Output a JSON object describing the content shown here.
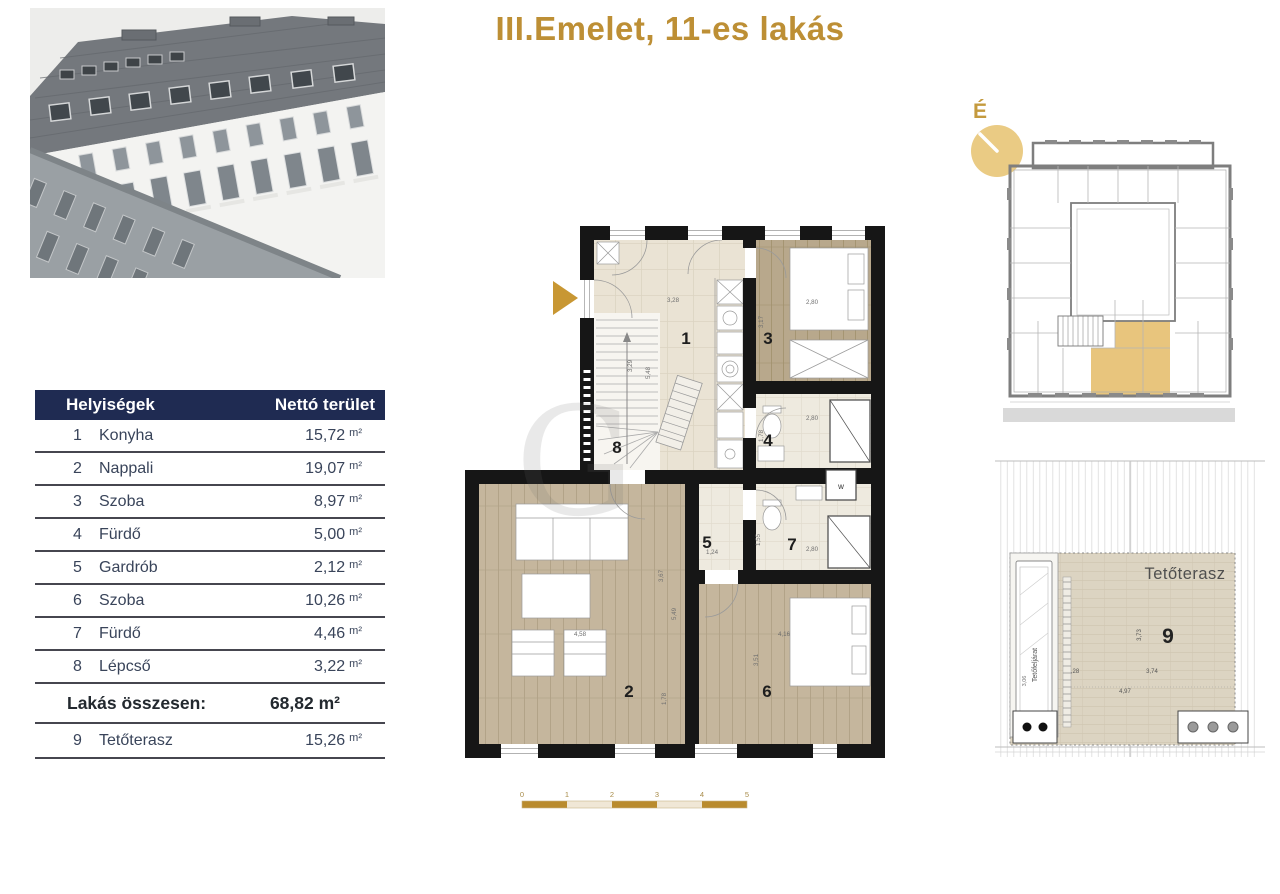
{
  "title": "III.Emelet, 11-es lakás",
  "colors": {
    "accent_gold": "#BD8F35",
    "compass_gold": "#EACB84",
    "unit_highlight": "#E8C57D",
    "table_header_navy": "#1F2B52",
    "wall_black": "#161616",
    "wood_floor": "#C5B69D",
    "scale_gold": "#B98B2E"
  },
  "table": {
    "headers": {
      "rooms": "Helyiségek",
      "area": "Nettó terület"
    },
    "rows": [
      {
        "num": "1",
        "name": "Konyha",
        "value": "15,72",
        "unit": "m²"
      },
      {
        "num": "2",
        "name": "Nappali",
        "value": "19,07",
        "unit": "m²"
      },
      {
        "num": "3",
        "name": "Szoba",
        "value": "8,97",
        "unit": "m²"
      },
      {
        "num": "4",
        "name": "Fürdő",
        "value": "5,00",
        "unit": "m²"
      },
      {
        "num": "5",
        "name": "Gardrób",
        "value": "2,12",
        "unit": "m²"
      },
      {
        "num": "6",
        "name": "Szoba",
        "value": "10,26",
        "unit": "m²"
      },
      {
        "num": "7",
        "name": "Fürdő",
        "value": "4,46",
        "unit": "m²"
      },
      {
        "num": "8",
        "name": "Lépcső",
        "value": "3,22",
        "unit": "m²"
      }
    ],
    "total": {
      "label": "Lakás összesen:",
      "value": "68,82 m²"
    },
    "terrace_row": {
      "num": "9",
      "name": "Tetőterasz",
      "value": "15,26",
      "unit": "m²"
    }
  },
  "floor_plan": {
    "rooms": [
      "1",
      "2",
      "3",
      "4",
      "5",
      "6",
      "7",
      "8"
    ],
    "dims": [
      "3,28",
      "3,29",
      "5,48",
      "2,80",
      "3,17",
      "2,80",
      "1,78",
      "1,24",
      "1,55",
      "2,80",
      "3,67",
      "5,49",
      "4,58",
      "1,78",
      "4,16",
      "3,51"
    ],
    "boiler_label": "w"
  },
  "key_plan": {
    "compass_label": "É"
  },
  "terrace_plan": {
    "label": "Tetőterasz",
    "room_number": "9",
    "stair_label": "Tetőfeljárat",
    "dims": {
      "offset": ",28",
      "inner_width": "3,74",
      "width": "4,97",
      "height": "3,73",
      "stair": "3,06"
    }
  },
  "scale_bar": {
    "ticks": [
      "0",
      "1",
      "2",
      "3",
      "4",
      "5"
    ]
  },
  "watermark": {
    "letter": "G"
  }
}
